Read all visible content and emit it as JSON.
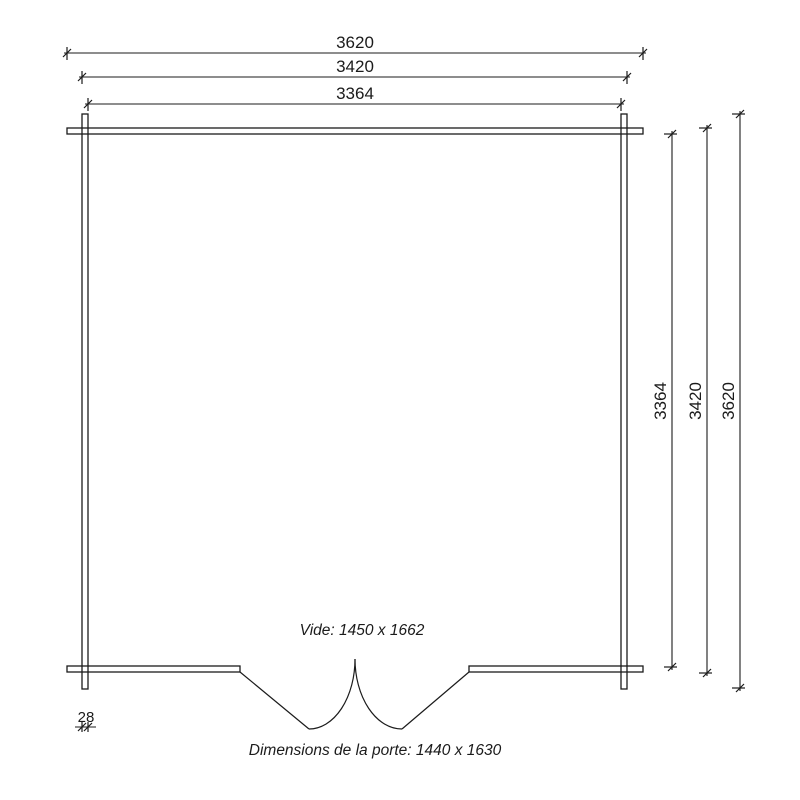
{
  "floor_plan": {
    "line_color": "#1b1b1b",
    "top_dimensions": [
      {
        "label": "3620"
      },
      {
        "label": "3420"
      },
      {
        "label": "3364"
      }
    ],
    "right_dimensions": [
      {
        "label": "3364"
      },
      {
        "label": "3420"
      },
      {
        "label": "3620"
      }
    ],
    "wall_thickness": {
      "label": "28"
    },
    "annotations": {
      "opening": "Vide: 1450 x 1662",
      "door": "Dimensions de la porte: 1440 x 1630"
    }
  }
}
